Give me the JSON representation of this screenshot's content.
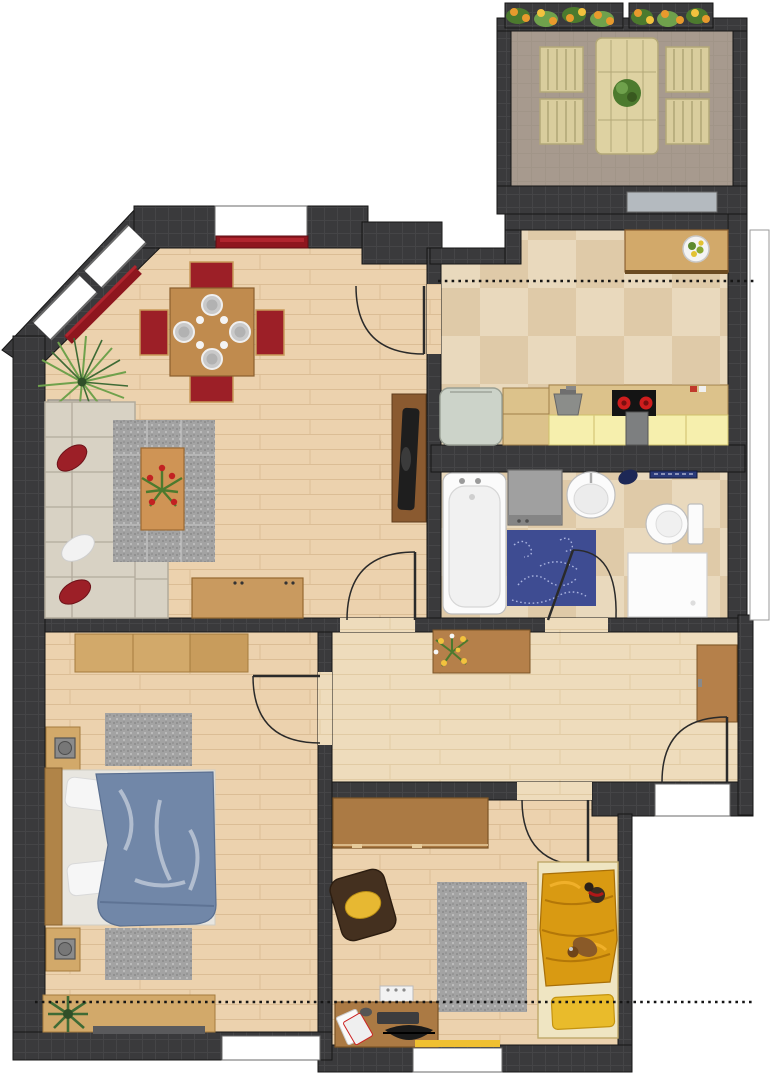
{
  "plan": {
    "type": "apartment floor plan, top-down 2D render, no visible text labels",
    "rooms": [
      {
        "id": "balcony",
        "label": "Balcony",
        "furniture": [
          "wooden garden table",
          "potted plant on table",
          "four slatted garden chairs",
          "two flower boxes with orange flowers"
        ]
      },
      {
        "id": "living-room",
        "label": "Living / dining room",
        "furniture": [
          "square dining table",
          "four red dining chairs",
          "four gray place settings with glasses",
          "red sideboard under top window",
          "red sideboard along diagonal wall",
          "palm plant with pot",
          "cream corner sofa",
          "two red cushions",
          "white cushion",
          "gray speckled rug",
          "coffee table with red flower bouquet",
          "TV lowboard with black TV",
          "wooden sideboard with handles"
        ]
      },
      {
        "id": "kitchen",
        "label": "Kitchen",
        "furniture": [
          "breakfast counter with fruit bowl",
          "glazed balcony door",
          "fridge",
          "wooden cabinet",
          "gray sink",
          "black stove with two red burners",
          "gray stool",
          "pale yellow counter front"
        ]
      },
      {
        "id": "bathroom",
        "label": "Bathroom",
        "furniture": [
          "bathtub",
          "washing machine",
          "oval wash basin",
          "navy towel",
          "navy towel rail",
          "toilet with cistern",
          "shower tray",
          "blue swirl rug"
        ]
      },
      {
        "id": "hallway",
        "label": "Hallway",
        "furniture": [
          "dresser with yellow flower bouquet",
          "tall wardrobe cabinet",
          "entrance door"
        ]
      },
      {
        "id": "bedroom",
        "label": "Bedroom",
        "furniture": [
          "long wardrobe",
          "double bed with blue duvet and white pillows",
          "two nightstands with gray pots",
          "two gray speckled rugs",
          "low wooden bench",
          "green plant",
          "radiator"
        ]
      },
      {
        "id": "kids-room",
        "label": "Kids room / office",
        "furniture": [
          "wall shelf unit",
          "dark brown armchair with yellow cushion",
          "gray speckled rug",
          "bed with gold crumpled duvet",
          "two teddy bears",
          "yellow pillow",
          "desk with keyboard, papers and mouse",
          "black desk chair",
          "radiator",
          "yellow windowsill strip"
        ]
      }
    ],
    "architecture": {
      "doors": [
        "living-room to kitchen swing door",
        "living-room to hallway swing door",
        "hallway to bedroom swing door",
        "hallway to kids-room swing door",
        "hallway to bathroom swing door",
        "apartment entrance door bottom right",
        "sliding glass balcony door"
      ],
      "windows": [
        "two windows on top-left diagonal wall",
        "window on living-room top wall",
        "window on bedroom bottom wall",
        "window on kids-room bottom wall"
      ],
      "section_lines": [
        "dotted cut line across kitchen",
        "dotted cut line across bedroom and kids room"
      ]
    }
  },
  "palette": {
    "exterior": "#ffffff",
    "wall": "#3a3a3c",
    "wallGrid": "#47474a",
    "outline": "#161616",
    "woodFloor": "#ecd2ae",
    "woodLine": "#d9ba90",
    "hallFloor": "#eedcbc",
    "tileA": "#e9d9bd",
    "tileB": "#dfcaa8",
    "balconyFloor": "#a79a8e",
    "deckWood": "#ded2a2",
    "deckWood2": "#d9cd9d",
    "deckLine": "#b3a878",
    "red": "#9c1f27",
    "darkRed": "#8e161e",
    "tableWood": "#c08b4e",
    "midWood": "#b5804a",
    "darkWood": "#7c5426",
    "tan": "#d2a96a",
    "cream": "#d8d2c4",
    "creamEdge": "#b2ab9c",
    "white": "#fbfbfb",
    "rugGray": "#a3a3a3",
    "rugBlue": "#3e4c92",
    "rugBlueLine": "#aab4e0",
    "counterWood": "#dcc28b",
    "counterYellow": "#f6efad",
    "fridge": "#ccd3c9",
    "steel": "#8b8d8a",
    "stove": "#141414",
    "burner": "#cf1d1d",
    "navy": "#1d2856",
    "towelBlue": "#2a3a7a",
    "duvetBlue": "#7187a8",
    "gold": "#d99a12",
    "goldLight": "#e9bb2b",
    "bedFrameCream": "#efe5c2",
    "armchairBrown": "#44301f",
    "cushionYellow": "#e7b832",
    "green": "#4c7a2e",
    "greenLight": "#6fa14c",
    "flowerOrange": "#e89a2d",
    "flowerYellow": "#f2c23e",
    "tv": "#1e1e1e",
    "sill": "#f0c030",
    "doorLine": "#2a2a2a",
    "glassDoor": "#b4babf"
  }
}
